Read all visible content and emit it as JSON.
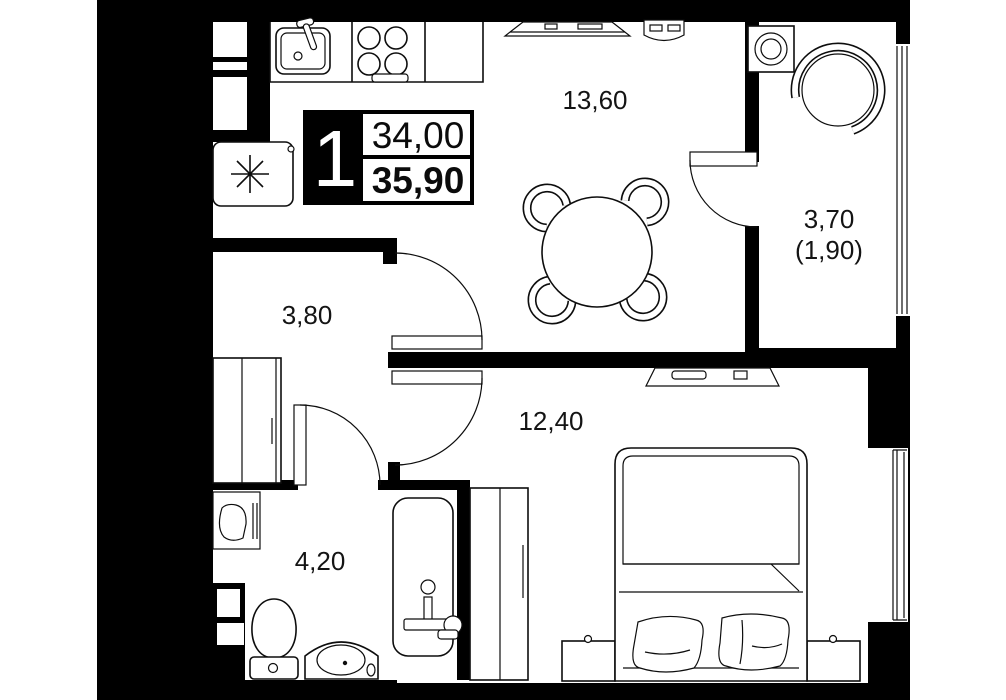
{
  "plan": {
    "unit": {
      "rooms_count": "1",
      "area_main": "34,00",
      "area_total": "35,90"
    },
    "rooms": {
      "kitchen_living": {
        "area": "13,60"
      },
      "balcony": {
        "area": "3,70",
        "area_coefficient": "(1,90)"
      },
      "hallway": {
        "area": "3,80"
      },
      "bedroom": {
        "area": "12,40"
      },
      "bathroom": {
        "area": "4,20"
      }
    },
    "colors": {
      "wall": "#000000",
      "floor": "#ffffff",
      "outline": "#0d0d0d"
    }
  }
}
